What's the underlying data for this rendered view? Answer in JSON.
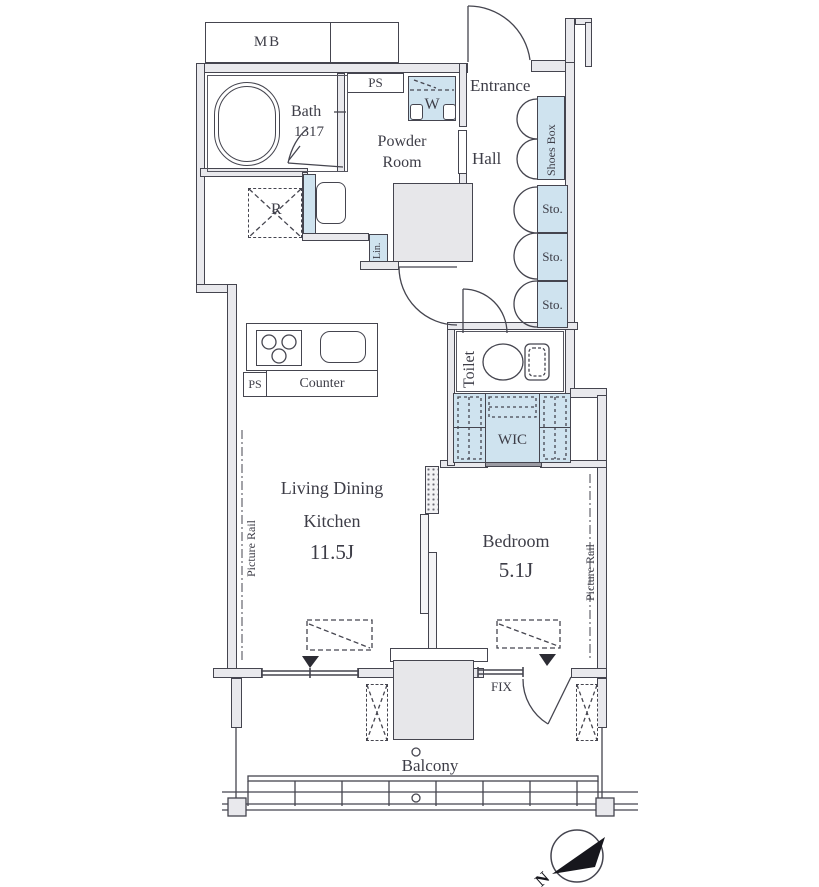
{
  "plan": {
    "title": "1LDK apartment floor plan",
    "labels": {
      "mb": "MB",
      "ps_top": "PS",
      "bath": "Bath",
      "bath_size": "1317",
      "powder_line1": "Powder",
      "powder_line2": "Room",
      "washer": "W",
      "entrance": "Entrance",
      "hall": "Hall",
      "shoes_box": "Shoes Box",
      "storage": "Sto.",
      "fridge": "R",
      "linen": "Lin.",
      "toilet": "Toilet",
      "wic": "WIC",
      "counter": "Counter",
      "ps_kitchen": "PS",
      "ldk_line1": "Living Dining",
      "ldk_line2": "Kitchen",
      "ldk_size": "11.5J",
      "bedroom": "Bedroom",
      "bedroom_size": "5.1J",
      "picture_rail": "Picture Rail",
      "fix": "FIX",
      "balcony": "Balcony",
      "north": "N"
    },
    "colors": {
      "fixture_blue": "#cfe3ef",
      "wall_fill": "#e9e9ed",
      "line": "#45454f",
      "text": "#3d3d47"
    }
  }
}
